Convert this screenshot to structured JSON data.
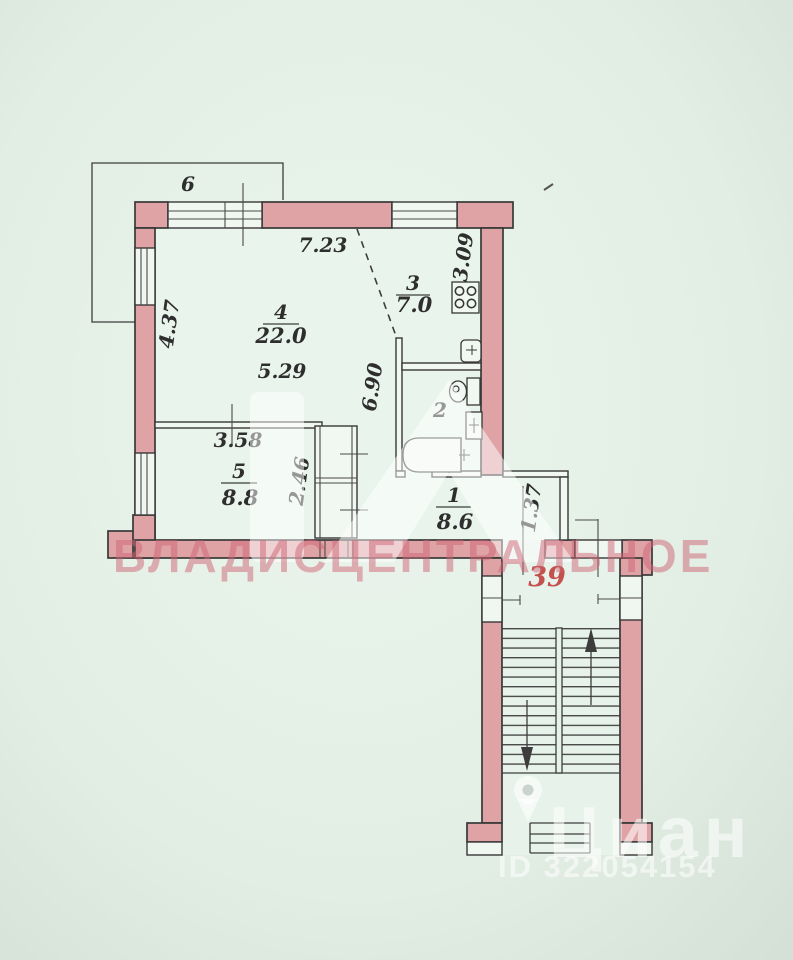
{
  "plan": {
    "balcony": {
      "number": "6"
    },
    "rooms": {
      "hall": {
        "number": "1",
        "area": "8.6"
      },
      "bathroom": {
        "number": "2"
      },
      "kitchen": {
        "number": "3",
        "area": "7.0"
      },
      "living_room": {
        "number": "4",
        "area": "22.0"
      },
      "bedroom": {
        "number": "5",
        "area": "8.8"
      }
    },
    "dimensions": {
      "living_width": "7.23",
      "kitchen_depth": "3.09",
      "living_depth": "4.37",
      "living_width_inner": "5.29",
      "corridor_length": "6.90",
      "bedroom_width": "3.58",
      "closet_depth": "2.46",
      "entry_width": "1.37"
    },
    "apartment_number": "39"
  },
  "watermarks": {
    "agency_name": "ВЛАДИСЦЕНТРАЛЬНОЕ",
    "portal_name": "Циан",
    "listing_id": "ID 322054154"
  },
  "icons": [
    "stove-icon",
    "kitchen-sink-icon",
    "toilet-icon",
    "bathroom-sink-icon",
    "bathtub-icon",
    "stairs-up-arrow-icon",
    "stairs-down-arrow-icon",
    "house-logo-icon",
    "location-pin-icon"
  ],
  "colors": {
    "background": "#e4efe6",
    "wall_fill": "#dfa3a6",
    "line": "#3d3d3d",
    "apartment_number_red": "#c5514f",
    "agency_watermark_pink": "rgba(205,100,115,0.5)"
  }
}
